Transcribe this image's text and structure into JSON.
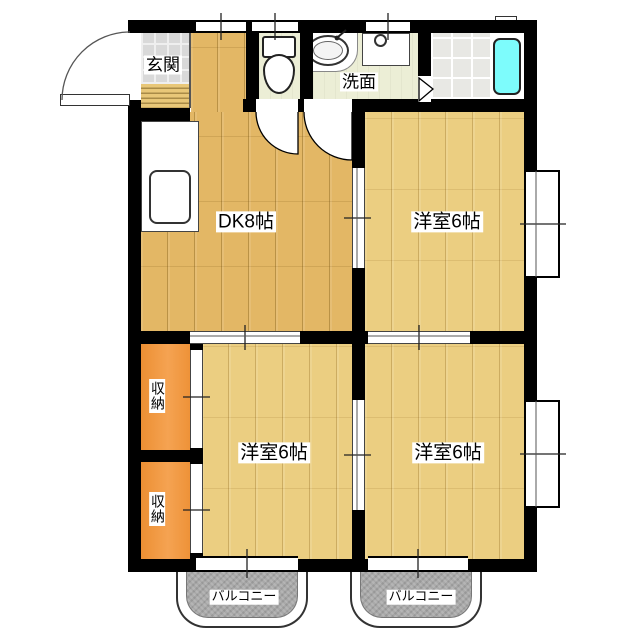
{
  "floorplan": {
    "labels": {
      "genkan": "玄関",
      "washroom": "洗面",
      "dk": "DK8帖",
      "bedroom_ne": "洋室6帖",
      "bedroom_s": "洋室6帖",
      "bedroom_se": "洋室6帖",
      "closet_1": "収納",
      "closet_2": "収納",
      "balcony_1": "バルコニー",
      "balcony_2": "バルコニー"
    },
    "colors": {
      "wall": "#000000",
      "dk_floor": "#e3b765",
      "bedroom_floor": "#ebce81",
      "closet": "#f0973d",
      "bathtub": "#7dfcfc",
      "genkan_tile": "#d9d9d9",
      "bath_tile": "#e8e8e4",
      "service_floor": "#eceed6",
      "balcony": "#a9a9a9"
    }
  }
}
